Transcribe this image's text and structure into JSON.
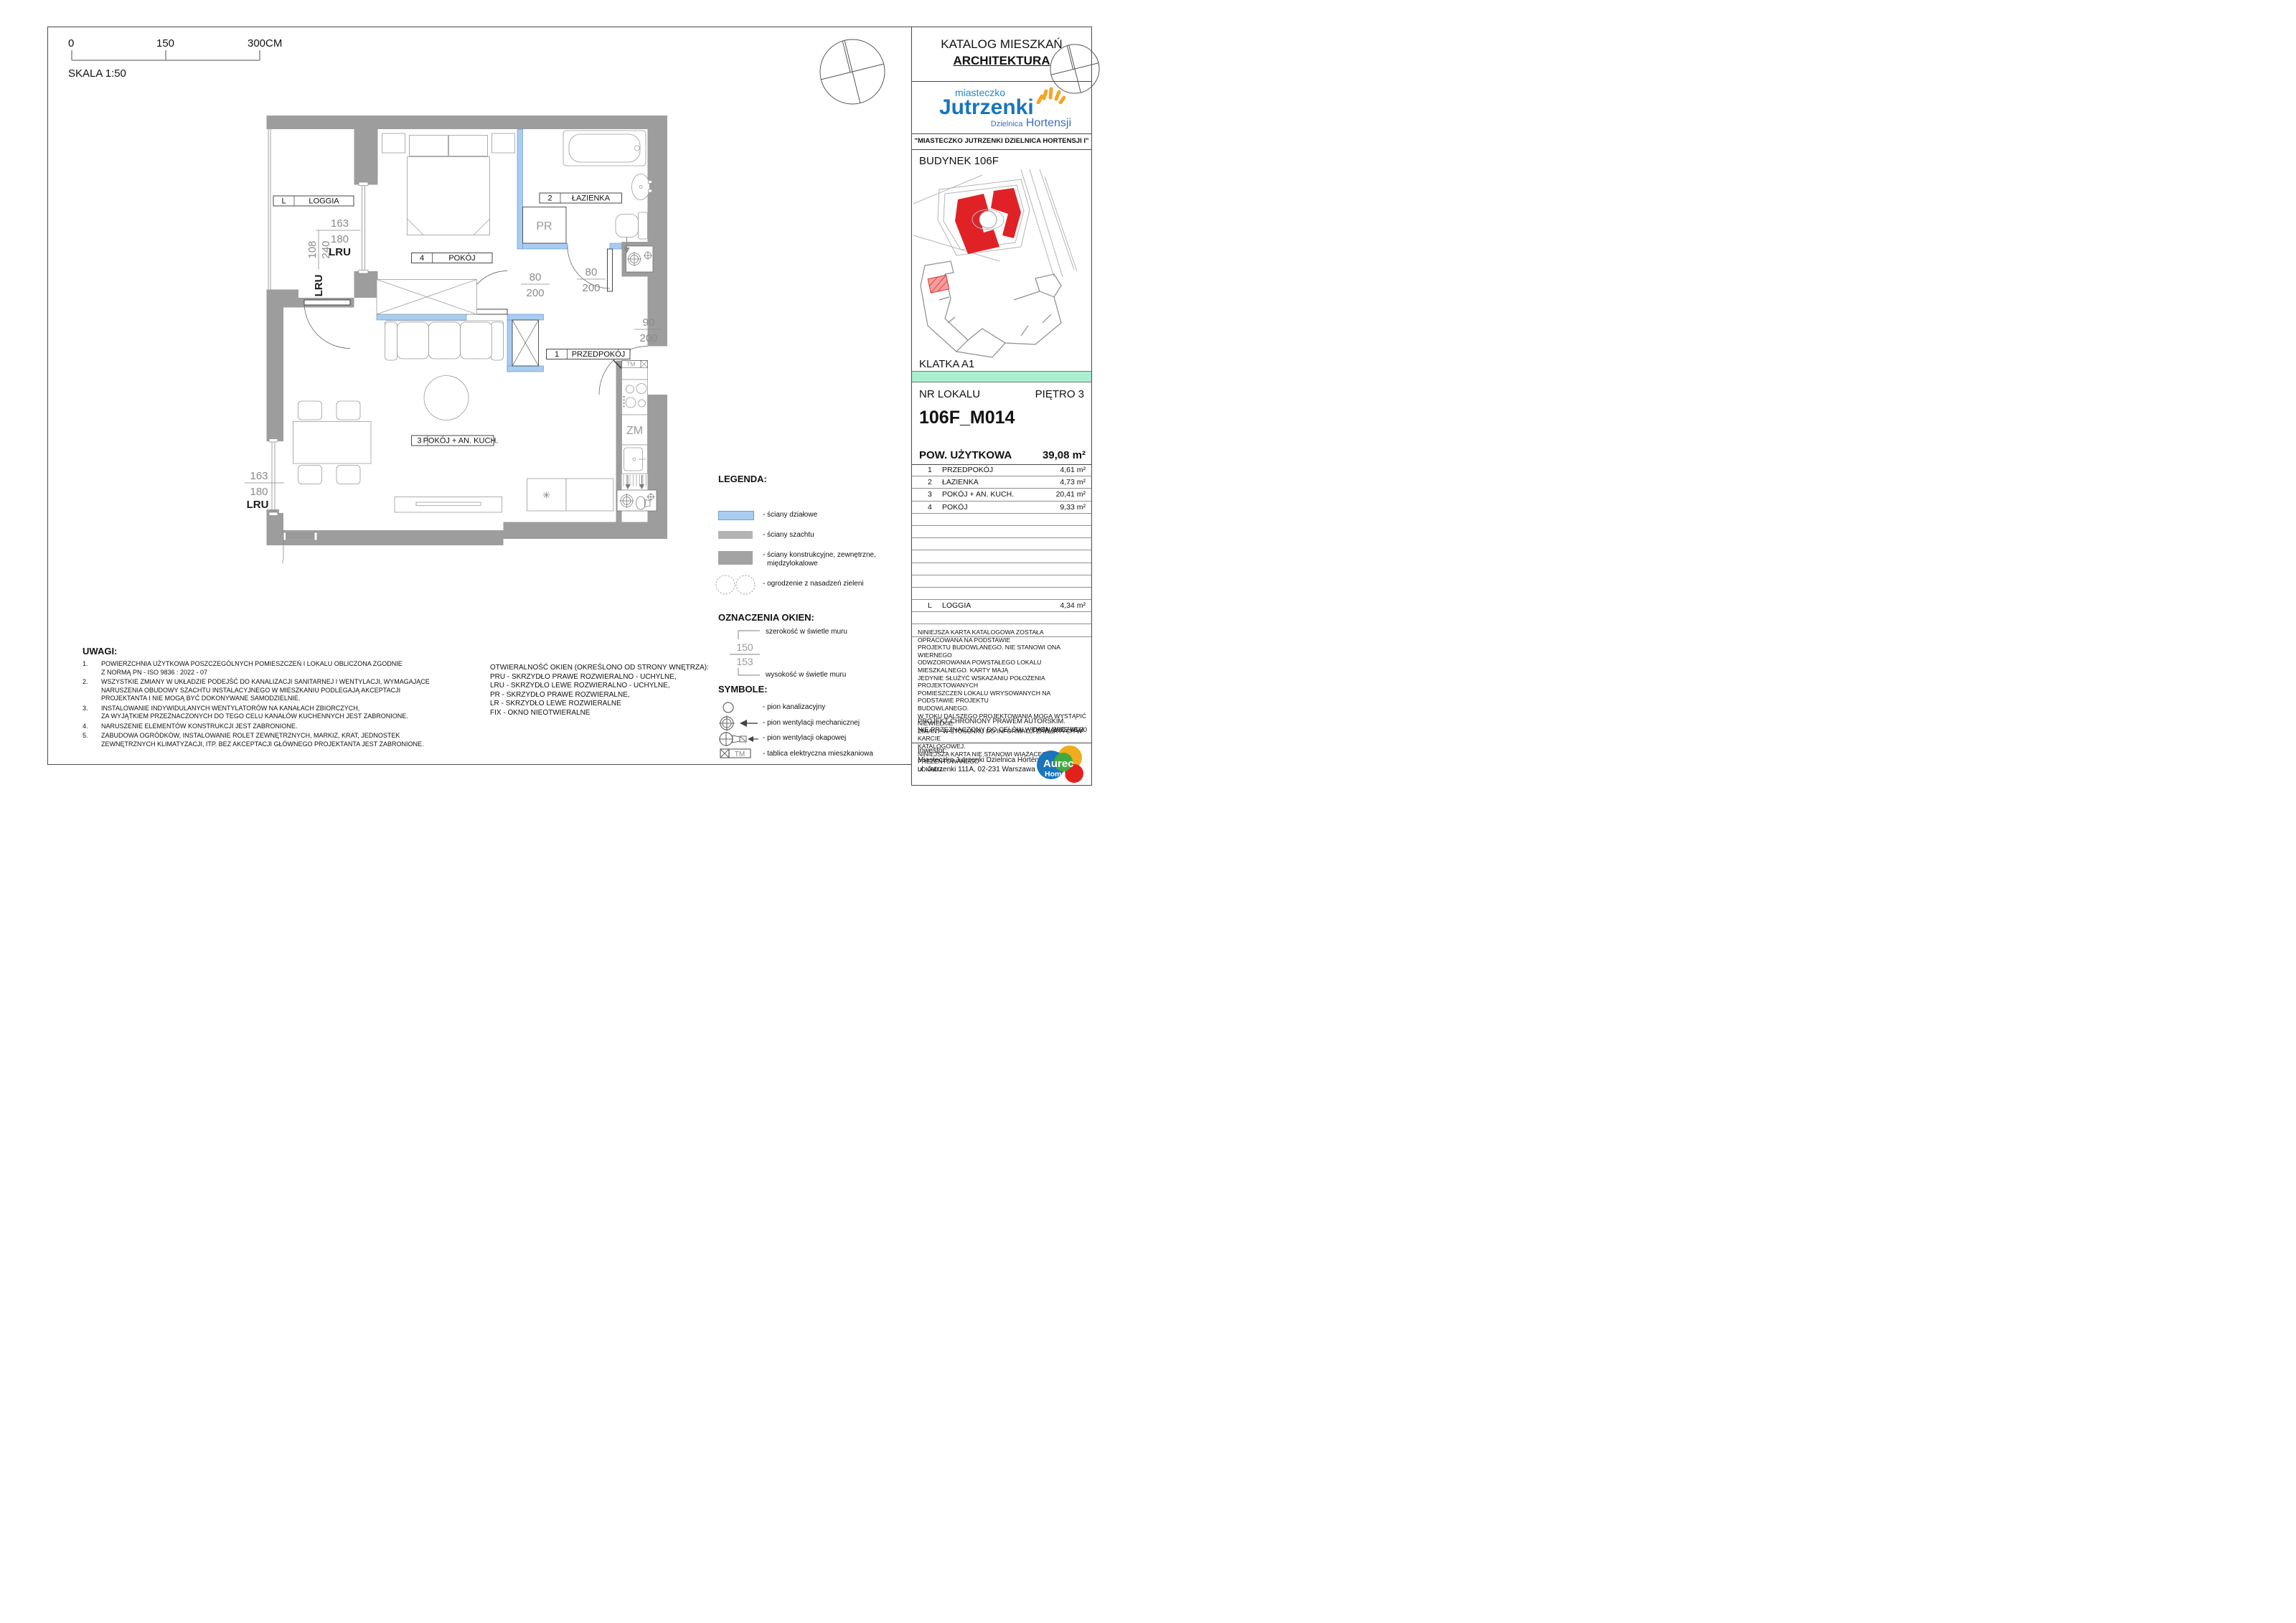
{
  "page": {
    "skala": "SKALA 1:50",
    "scale_ticks": [
      "0",
      "150",
      "300CM"
    ]
  },
  "title_block": {
    "catalog": "KATALOG MIESZKAŃ",
    "discipline": "ARCHITEKTURA",
    "logo": {
      "line1": "miasteczko",
      "line2": "Jutrzenki",
      "line3a": "Dzielnica",
      "line3b": "Hortensji"
    },
    "project": "\"MIASTECZKO JUTRZENKI DZIELNICA HORTENSJI I\"",
    "building": "BUDYNEK 106F",
    "staircase": "KLATKA A1",
    "unit_label": "NR LOKALU",
    "floor": "PIĘTRO 3",
    "unit_id": "106F_M014",
    "area_label": "POW. UŻYTKOWA",
    "area_value": "39,08 m²",
    "rooms": [
      {
        "no": "1",
        "name": "PRZEDPOKÓJ",
        "area": "4,61 m²"
      },
      {
        "no": "2",
        "name": "ŁAZIENKA",
        "area": "4,73 m²"
      },
      {
        "no": "3",
        "name": "POKÓJ + AN. KUCH.",
        "area": "20,41 m²"
      },
      {
        "no": "4",
        "name": "POKÓJ",
        "area": "9,33 m²"
      }
    ],
    "loggia_row": {
      "no": "L",
      "name": "LOGGIA",
      "area": "4,34 m²"
    },
    "disclaimer": "NINIEJSZA KARTA KATALOGOWA ZOSTAŁA OPRACOWANA NA PODSTAWIE\nPROJEKTU BUDOWLANEGO. NIE STANOWI ONA WIERNEGO\nODWZOROWANIA POWSTAŁEGO LOKALU MIESZKALNEGO. KARTY MAJĄ\nJEDYNIE SŁUŻYĆ WSKAZANIU POŁOŻENIA PROJEKTOWANYCH\nPOMIESZCZEŃ LOKALU WRYSOWANYCH NA PODSTAWIE PROJEKTU\nBUDOWLANEGO.\nW TOKU DALSZEGO PROJEKTOWANIA MOGĄ WYSTĄPIĆ NIEWIELKIE\nZMIANY W STOSUNKU DO INFORMACJI ZAWARTYCH W KARCIE\nKATALOGOWEJ.\nNINIEJSZA KARTA NIE STANOWI WIĄŻĄCEGO OPISU PREZENTOWANEGO\nLOKALU.",
    "copyright1": "PROJEKT CHRONIONY PRAWEM AUTORSKIM.",
    "copyright2": "NIE PRZEZNACZONY DO CELÓW WYKONAWCZYCH.",
    "date": "DATA_2025-08-20",
    "investor_label": "Inwestor:",
    "investor_name": "Miasteczko Jutrzenki Dzielnica Hortensji Sp. z o.o.",
    "investor_addr": "ul. Jutrzenki 111A, 02-231 Warszawa",
    "aurec": {
      "l1": "Aurec",
      "l2": "Home"
    }
  },
  "plan": {
    "room_tags": [
      {
        "no": "L",
        "name": "LOGGIA"
      },
      {
        "no": "4",
        "name": "POKÓJ"
      },
      {
        "no": "2",
        "name": "ŁAZIENKA"
      },
      {
        "no": "1",
        "name": "PRZEDPOKÓJ"
      },
      {
        "no": "3",
        "name": "POKÓJ + AN. KUCH."
      }
    ],
    "dims": {
      "win_up_w": "163",
      "win_up_h": "180",
      "win_up_type": "LRU",
      "door_loggia_type": "LRU",
      "door_loggia_w": "108",
      "door_loggia_h": "240",
      "door_bed_w": "80",
      "door_bed_h": "200",
      "door_bath_w": "80",
      "door_bath_h": "200",
      "door_entry_w": "90",
      "door_entry_h": "200",
      "win_low_w": "163",
      "win_low_h": "180",
      "win_low_type": "LRU",
      "win_small_w": "60",
      "win_small_h": "180"
    },
    "appliances": {
      "pr": "PR",
      "zm": "ZM",
      "tm": "TM",
      "fridge": "✳"
    }
  },
  "legend": {
    "title": "LEGENDA:",
    "item1": "- ściany działowe",
    "item2": "- ściany szachtu",
    "item3a": "- ściany konstrukcyjne, zewnętrzne,",
    "item3b": "międzylokalowe",
    "item4": "- ogrodzenie z nasadzeń zieleni"
  },
  "window_markings": {
    "title": "OZNACZENIA OKIEN:",
    "width_label": "szerokość w świetle muru",
    "height_label": "wysokość w świetle muru",
    "example_w": "150",
    "example_h": "153"
  },
  "symbols": {
    "title": "SYMBOLE:",
    "item1": "- pion kanalizacyjny",
    "item2": "- pion wentylacji mechanicznej",
    "item3": "- pion wentylacji okapowej",
    "item4": "- tablica elektryczna mieszkaniowa",
    "tm": "TM"
  },
  "uwagi": {
    "title": "UWAGI:",
    "n1": "1.",
    "n2": "2.",
    "n3": "3.",
    "n4": "4.",
    "n5": "5.",
    "i1": "POWIERZCHNIA UŻYTKOWA POSZCZEGÓLNYCH POMIESZCZEŃ I LOKALU OBLICZONA ZGODNIE\nZ NORMĄ PN - ISO 9836 : 2022 - 07",
    "i2": "WSZYSTKIE ZMIANY W UKŁADZIE PODEJŚĆ DO KANALIZACJI SANITARNEJ I WENTYLACJI, WYMAGAJĄCE\nNARUSZENIA OBUDOWY SZACHTU INSTALACYJNEGO W MIESZKANIU PODLEGAJĄ AKCEPTACJI\nPROJEKTANTA I NIE MOGĄ BYĆ DOKONYWANE SAMODZIELNIE.",
    "i3": "INSTALOWANIE INDYWIDULANYCH WENTYLATORÓW NA KANAŁACH ZBIORCZYCH,\nZA WYJĄTKIEM PRZEZNACZONYCH DO TEGO CELU KANAŁÓW KUCHENNYCH JEST ZABRONIONE.",
    "i4": "NARUSZENIE ELEMENTÓW KONSTRUKCJI JEST ZABRONIONE.",
    "i5": "ZABUDOWA OGRÓDKÓW, INSTALOWANIE ROLET ZEWNĘTRZNYCH, MARKIZ, KRAT, JEDNOSTEK\nZEWNĘTRZNYCH  KLIMATYZACJI, ITP. BEZ AKCEPTACJI GŁÓWNEGO PROJEKTANTA JEST ZABRONIONE."
  },
  "otwieralnosc": {
    "l1": "OTWIERALNOŚĆ OKIEN (OKREŚLONO OD STRONY WNĘTRZA):",
    "l2": "PRU - SKRZYDŁO PRAWE ROZWIERALNO - UCHYLNE,",
    "l3": "LRU - SKRZYDŁO LEWE ROZWIERALNO - UCHYLNE,",
    "l4": "PR - SKRZYDŁO PRAWE ROZWIERALNE,",
    "l5": "LR - SKRZYDŁO LEWE ROZWIERALNE",
    "l6": "FIX - OKNO NIEOTWIERALNE"
  },
  "colors": {
    "wall": "#9d9d9d",
    "partition_fill": "#a9cdf2",
    "partition_edge": "#5c8fca",
    "teal_bar": "#a9efd0",
    "building_red": "#e02227",
    "logo_blue": "#1a75bc",
    "logo_orange": "#f5a623"
  }
}
